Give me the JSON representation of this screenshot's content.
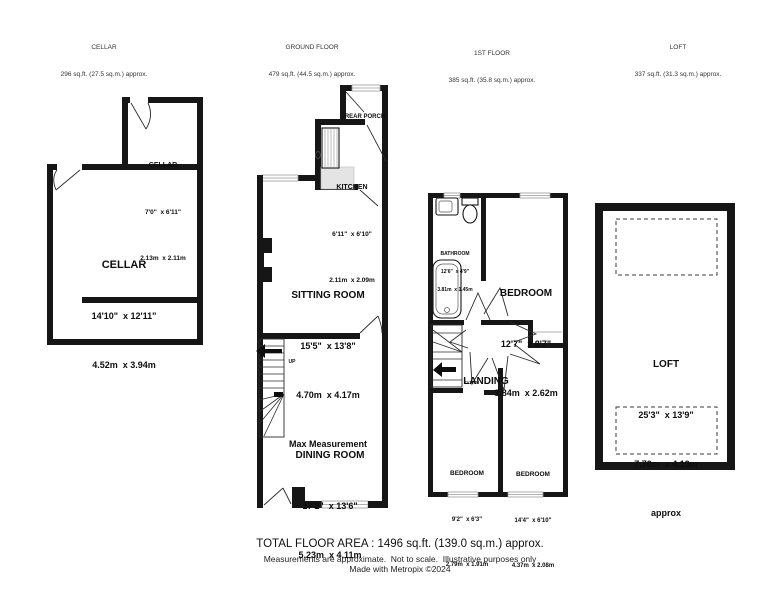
{
  "colors": {
    "wall": "#161616",
    "background": "#ffffff"
  },
  "headers": {
    "cellar": {
      "title": "CELLAR",
      "area": "296 sq.ft. (27.5 sq.m.) approx."
    },
    "ground": {
      "title": "GROUND FLOOR",
      "area": "479 sq.ft. (44.5 sq.m.) approx."
    },
    "first": {
      "title": "1ST FLOOR",
      "area": "385 sq.ft. (35.8 sq.m.) approx."
    },
    "loft": {
      "title": "LOFT",
      "area": "337 sq.ft. (31.3 sq.m.) approx."
    }
  },
  "rooms": {
    "cellar_small": {
      "name": "CELLAR",
      "imperial": "7'0\"  x 6'11\"",
      "metric": "2.13m  x 2.11m"
    },
    "cellar_main": {
      "name": "CELLAR",
      "imperial": "14'10\"  x 12'11\"",
      "metric": "4.52m  x 3.94m"
    },
    "rear_porch": {
      "name": "REAR PORCH"
    },
    "kitchen": {
      "name": "KITCHEN",
      "imperial": "6'11\"  x 6'10\"",
      "metric": "2.11m  x 2.09m"
    },
    "sitting_room": {
      "name": "SITTING ROOM",
      "imperial": "15'5\"  x 13'8\"",
      "metric": "4.70m  x 4.17m",
      "note": "Max Measurement"
    },
    "dining_room": {
      "name": "DINING ROOM",
      "imperial": "17'2\"  x 13'6\"",
      "metric": "5.23m  x 4.11m"
    },
    "bathroom": {
      "name": "BATHROOM",
      "imperial": "12'6\"  x 4'9\"",
      "metric": "3.81m  x 1.45m"
    },
    "bedroom_rear": {
      "name": "BEDROOM",
      "imperial": "12'7\"  x 8'7\"",
      "metric": "3.84m  x 2.62m"
    },
    "landing": {
      "name": "LANDING"
    },
    "bedroom_middle": {
      "name": "BEDROOM",
      "imperial": "9'2\"  x 6'3\"",
      "metric": "2.79m  x 1.91m"
    },
    "bedroom_front": {
      "name": "BEDROOM",
      "imperial": "14'4\"  x 6'10\"",
      "metric": "4.37m  x 2.08m"
    },
    "loft": {
      "name": "LOFT",
      "imperial": "25'3\"  x 13'9\"",
      "metric": "7.70m  x 4.19m",
      "note": "approx"
    }
  },
  "stairs": {
    "up": "UP",
    "down": "DOWN"
  },
  "footer": {
    "total": "TOTAL FLOOR AREA : 1496 sq.ft. (139.0 sq.m.) approx.",
    "disclaimer": "Measurements are approximate.  Not to scale.  Illustrative purposes only",
    "credit": "Made with Metropix ©2024"
  }
}
